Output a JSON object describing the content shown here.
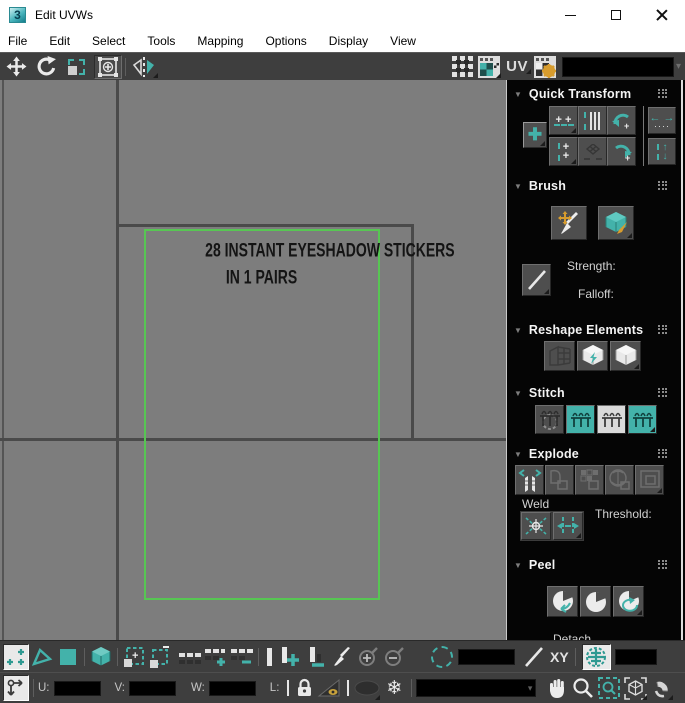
{
  "window": {
    "app_icon_text": "3",
    "title": "Edit UVWs"
  },
  "menu": [
    "File",
    "Edit",
    "Select",
    "Tools",
    "Mapping",
    "Options",
    "Display",
    "View"
  ],
  "top_toolbar": {
    "uv_label": "UV"
  },
  "canvas": {
    "texture_text_line1": "28 INSTANT EYESHADOW STICKERS",
    "texture_text_line2": "IN 1 PAIRS"
  },
  "sidebar": {
    "panels": [
      {
        "title": "Quick Transform"
      },
      {
        "title": "Brush",
        "strength_label": "Strength:",
        "falloff_label": "Falloff:"
      },
      {
        "title": "Reshape Elements"
      },
      {
        "title": "Stitch"
      },
      {
        "title": "Explode",
        "weld_label": "Weld",
        "threshold_label": "Threshold:"
      },
      {
        "title": "Peel",
        "detach_label": "Detach"
      }
    ]
  },
  "bottom_toolbar": {
    "xy_label": "XY"
  },
  "transform_row": {
    "u_label": "U:",
    "v_label": "V:",
    "w_label": "W:",
    "l_label": "L:"
  },
  "icons": {
    "snowflake": "❄",
    "gear": "⚙",
    "dropdown_arrow": "▾",
    "panel_collapse_arrow": "▼"
  },
  "colors": {
    "accent_teal": "#43b2aa",
    "selection_green": "#57c653",
    "canvas_gray": "#7d7d7d"
  }
}
